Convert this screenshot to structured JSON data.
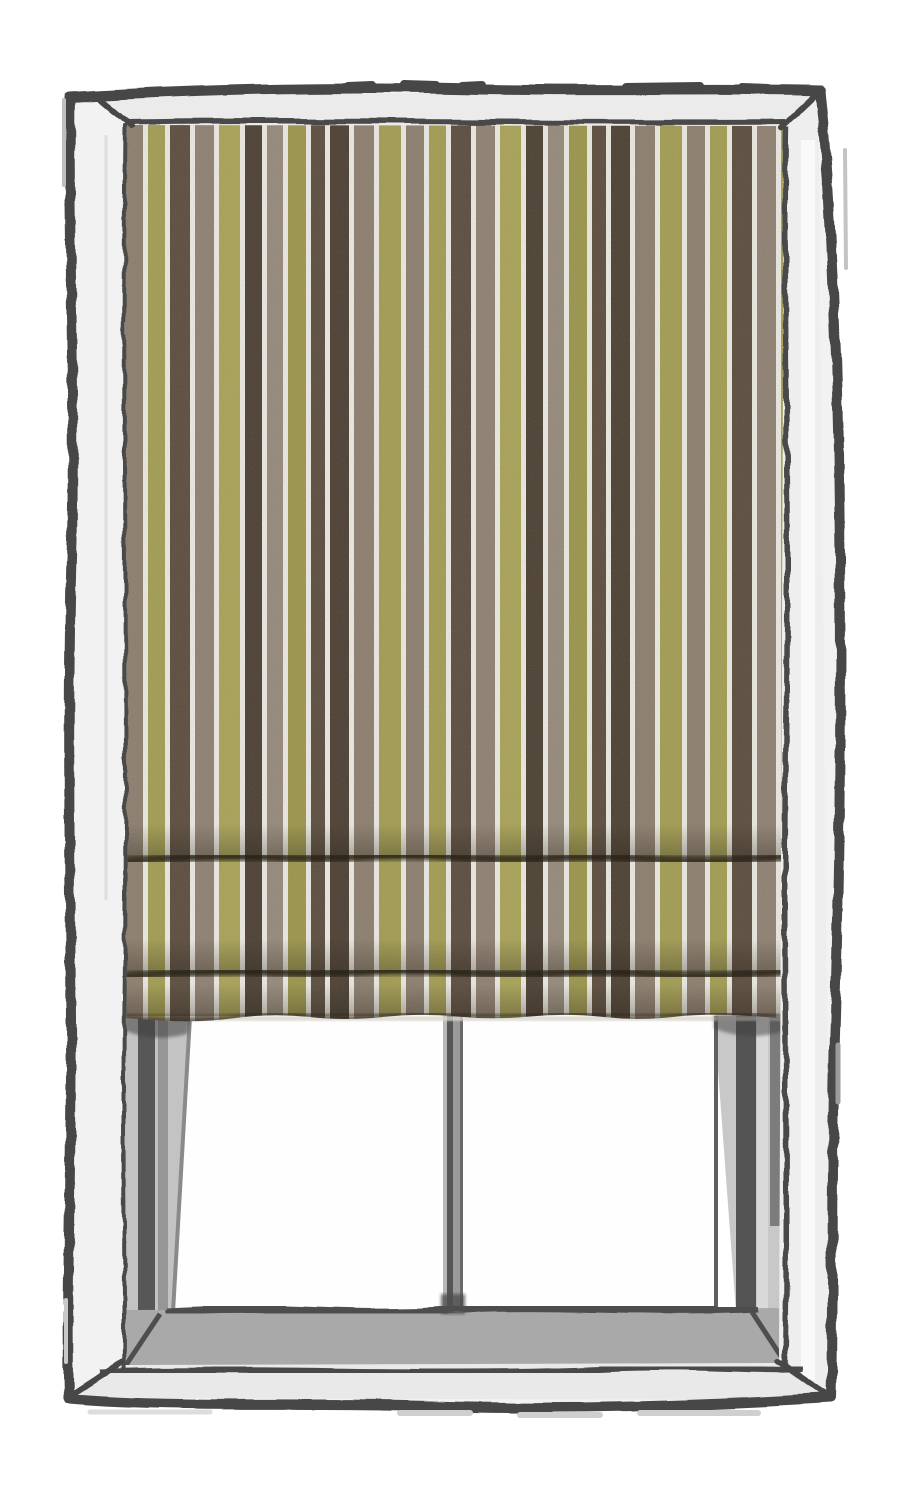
{
  "scene": {
    "type": "hand-drawn illustration",
    "subject": "window with striped roman blind partially lowered over a two-pane window",
    "background_color": "#ffffff"
  },
  "window": {
    "outline_color": "#474747",
    "frame_face_color": "#f2f2f2",
    "frame_face_top_color": "#ebebeb",
    "frame_face_bottom_color": "#e9e9e9",
    "frame_face_right_color": "#eeeeee",
    "reveal_color": "#c3c3c3",
    "reveal_streak_dark": "#4e4e4e",
    "reveal_streak_mid": "#969696",
    "sill_color": "#a9a9a9",
    "sill_front_color": "#e9e9e9",
    "pane_count": 2,
    "pane_color": "#fefefe",
    "pane_divider_line": "#4e4e4e",
    "mullion": {
      "highlight": "#b8b8b8",
      "dark": "#565656",
      "body": "#9a9a9a",
      "edge": "#6a6a6a"
    }
  },
  "blind": {
    "style": "roman-blind",
    "left_x": 125,
    "right_x": 788,
    "top_y": 122,
    "hem_y": 1016,
    "bottom_max_y": 1036,
    "fold_lines_y": [
      858,
      973
    ],
    "fold_count": 2,
    "fold_shadow_color": "#282219",
    "separator_color": "#EAE8DF",
    "separator_width": 5,
    "stripe_cycle": [
      {
        "name": "taupe",
        "color": "#8C7E6E",
        "width": 18
      },
      {
        "name": "olive",
        "color": "#A29C52",
        "width": 17
      },
      {
        "name": "brown",
        "color": "#5B4D3E",
        "width": 20
      },
      {
        "name": "taupe",
        "color": "#8F8172",
        "width": 19
      },
      {
        "name": "olive",
        "color": "#A8A257",
        "width": 21
      },
      {
        "name": "dark-brown",
        "color": "#4C4032",
        "width": 17
      },
      {
        "name": "taupe",
        "color": "#95897A",
        "width": 16
      },
      {
        "name": "olive",
        "color": "#9B954B",
        "width": 18
      },
      {
        "name": "brown",
        "color": "#5B4D3E",
        "width": 14
      },
      {
        "name": "dark-brown",
        "color": "#4C4032",
        "width": 19
      },
      {
        "name": "taupe",
        "color": "#8C7E6E",
        "width": 20
      },
      {
        "name": "olive",
        "color": "#A29C52",
        "width": 22
      }
    ]
  }
}
